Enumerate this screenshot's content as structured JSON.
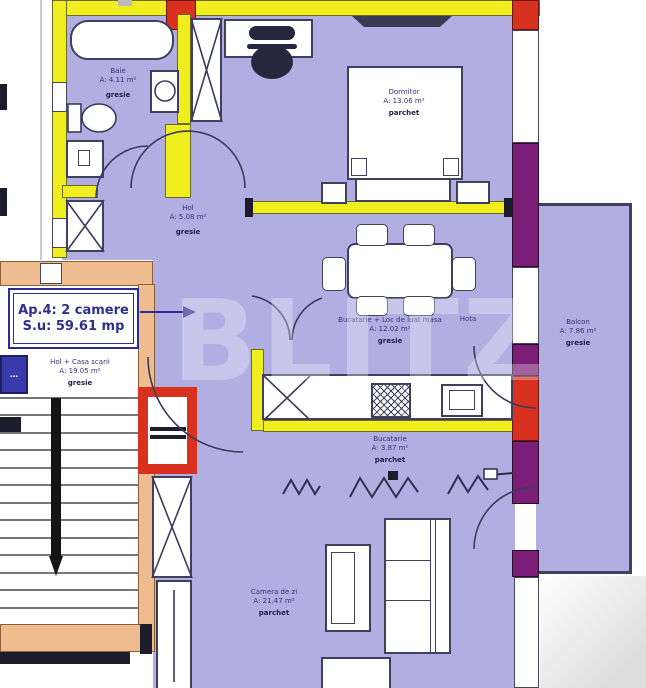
{
  "title": "Apartment 4 floor plan",
  "apartment_box": {
    "line1": "Ap.4: 2 camere",
    "line2": "S.u: 59.61 mp"
  },
  "rooms": [
    {
      "name": "Baie",
      "area": "A: 4.11 m²",
      "floor": "gresie"
    },
    {
      "name": "Dormitor",
      "area": "A: 13.06 m²",
      "floor": "parchet"
    },
    {
      "name": "Hol",
      "area": "A: 5.08 m²",
      "floor": "gresie"
    },
    {
      "name": "Bucatarie + Loc de luat masa",
      "area": "A: 12.02 m²",
      "floor": "gresie"
    },
    {
      "name": "Bucatarie",
      "area": "A: 3.87 m²",
      "floor": "parchet"
    },
    {
      "name": "Camera de zi",
      "area": "A: 21.47 m²",
      "floor": "parchet"
    },
    {
      "name": "Balcon",
      "area": "A: 7.86 m²",
      "floor": "gresie"
    },
    {
      "name": "Hol + Casa scarii",
      "area": "A: 19.05 m²",
      "floor": "gresie"
    }
  ],
  "annotations": {
    "hota": "Hota",
    "watermark": "BLITZ",
    "adjacent_partial": "…"
  },
  "legend_icons": [
    "bathtub-icon",
    "toilet-icon",
    "washing-machine-icon",
    "bed-icon",
    "desk-icon",
    "office-chair-icon",
    "dining-table-icon",
    "stove-icon",
    "fridge-icon",
    "radiator-icon",
    "stairs-icon",
    "door-arc-icon",
    "shaft-x-icon"
  ],
  "colors": {
    "wall_yellow": "#f1ee20",
    "wall_tan": "#eebc8e",
    "highlight_red": "#d9311f",
    "section_purple": "#7b1e78",
    "floor_lavender": "#b1afe2",
    "outline_navy": "#3f3f5f",
    "label_navy": "#33337c"
  }
}
